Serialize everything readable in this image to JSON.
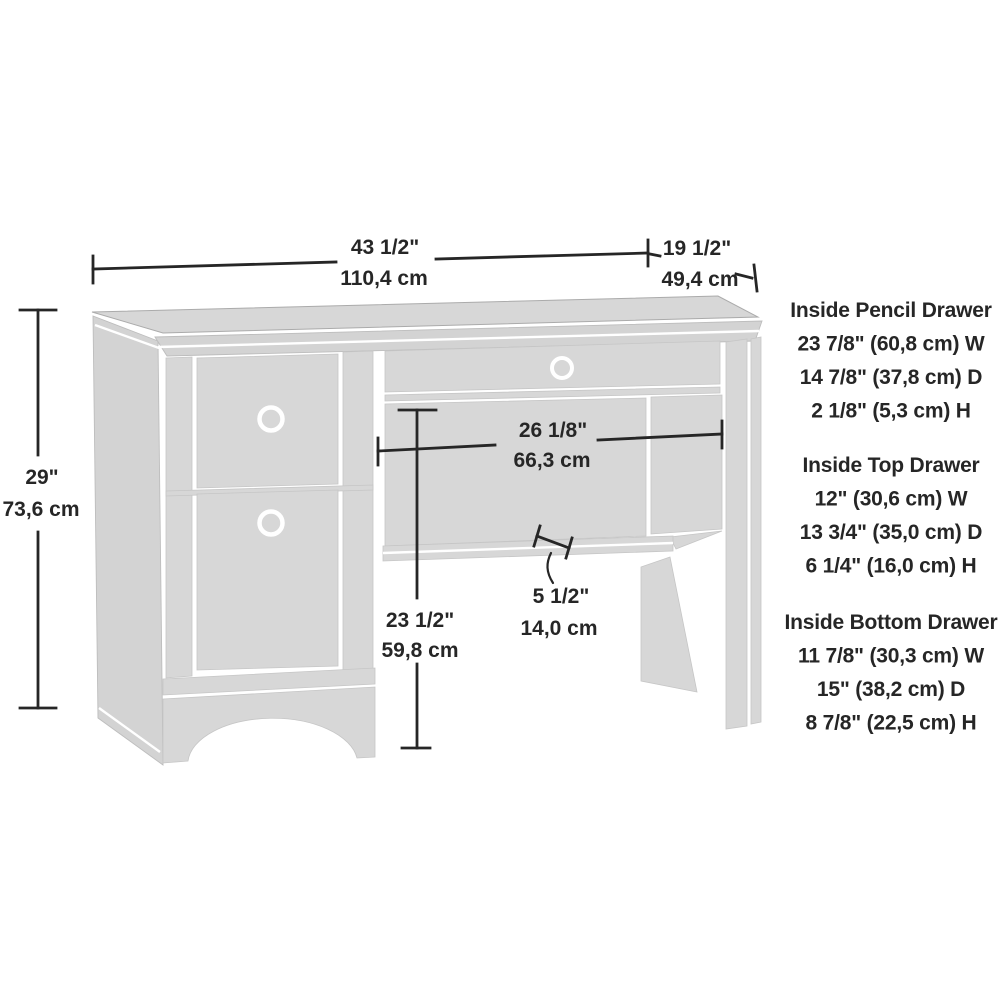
{
  "diagram": {
    "type": "product-dimension-line-drawing",
    "product": "single-pedestal computer desk",
    "colors": {
      "background": "#ffffff",
      "panel_fill": "#d7d7d7",
      "dimension_line": "#262626",
      "text": "#262626"
    },
    "dimensions": {
      "overall_width": {
        "inches": "43 1/2\"",
        "metric": "110,4 cm"
      },
      "overall_depth": {
        "inches": "19 1/2\"",
        "metric": "49,4 cm"
      },
      "overall_height": {
        "inches": "29\"",
        "metric": "73,6 cm"
      },
      "knee_space_width": {
        "inches": "26 1/8\"",
        "metric": "66,3 cm"
      },
      "knee_space_height": {
        "inches": "23 1/2\"",
        "metric": "59,8 cm"
      },
      "shelf_clearance": {
        "inches": "5 1/2\"",
        "metric": "14,0 cm"
      }
    },
    "drawer_specs": [
      {
        "title": "Inside Pencil Drawer",
        "lines": [
          "23 7/8\" (60,8 cm) W",
          "14 7/8\" (37,8 cm) D",
          "2 1/8\" (5,3 cm) H"
        ]
      },
      {
        "title": "Inside Top Drawer",
        "lines": [
          "12\" (30,6 cm) W",
          "13 3/4\" (35,0 cm) D",
          "6 1/4\" (16,0 cm) H"
        ]
      },
      {
        "title": "Inside Bottom Drawer",
        "lines": [
          "11 7/8\" (30,3 cm) W",
          "15\" (38,2 cm) D",
          "8 7/8\" (22,5 cm) H"
        ]
      }
    ]
  }
}
